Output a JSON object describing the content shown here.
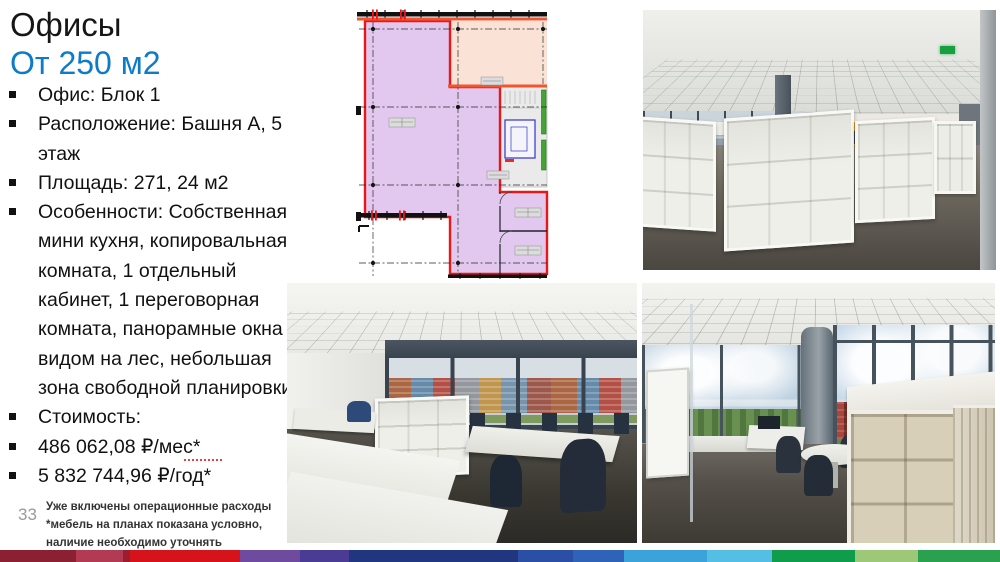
{
  "slide": {
    "title": "Офисы",
    "subtitle": "От 250 м2",
    "page_number": "33"
  },
  "bullets": [
    "Офис: Блок 1",
    "Расположение: Башня А, 5\nэтаж",
    "Площадь: 271, 24 м2",
    "Особенности: Собственная\nмини кухня, копировальная\nкомната, 1 отдельный\nкабинет, 1 переговорная\nкомната, панорамные окна с\nвидом на лес, небольшая\nзона свободной планировки",
    "Стоимость:",
    "486 062,08 ₽/мес*",
    "5 832 744,96 ₽/год*"
  ],
  "footnote": {
    "line1": "Уже включены операционные расходы",
    "line2": "*мебель на планах показана условно,",
    "line3": "наличие необходимо уточнять"
  },
  "images": {
    "floor_plan": {
      "alt": "floor-plan-office-block-1"
    },
    "photo_top_right": {
      "alt": "open-space-office-white-cabinets-orange-wall"
    },
    "photo_bottom_left": {
      "alt": "office-room-desks-chairs-city-view"
    },
    "photo_bottom_right": {
      "alt": "corner-office-panoramic-windows-forest-view"
    }
  },
  "colors": {
    "subtitle_blue": "#0C7BC8",
    "title_black": "#161616",
    "plan": {
      "area_purple": "#E2C7EE",
      "area_peach": "#FAE3D6",
      "highlight_red": "#E81818",
      "accent_orange_red": "#F2552F"
    },
    "footer_bar_segments": [
      {
        "color": "#8C2033",
        "width_pct": 7.6
      },
      {
        "color": "#B23A52",
        "width_pct": 4.7
      },
      {
        "color": "#9C1D2E",
        "width_pct": 0.7
      },
      {
        "color": "#D6121B",
        "width_pct": 11.0
      },
      {
        "color": "#6E4B9E",
        "width_pct": 6.0
      },
      {
        "color": "#4A3B95",
        "width_pct": 4.9
      },
      {
        "color": "#203780",
        "width_pct": 16.9
      },
      {
        "color": "#2A4FA5",
        "width_pct": 5.5
      },
      {
        "color": "#2F63B8",
        "width_pct": 5.1
      },
      {
        "color": "#3BA3DA",
        "width_pct": 8.3
      },
      {
        "color": "#55BEE4",
        "width_pct": 6.5
      },
      {
        "color": "#0F9C4B",
        "width_pct": 8.3
      },
      {
        "color": "#9DC878",
        "width_pct": 6.3
      },
      {
        "color": "#2AA14E",
        "width_pct": 8.2
      }
    ]
  }
}
